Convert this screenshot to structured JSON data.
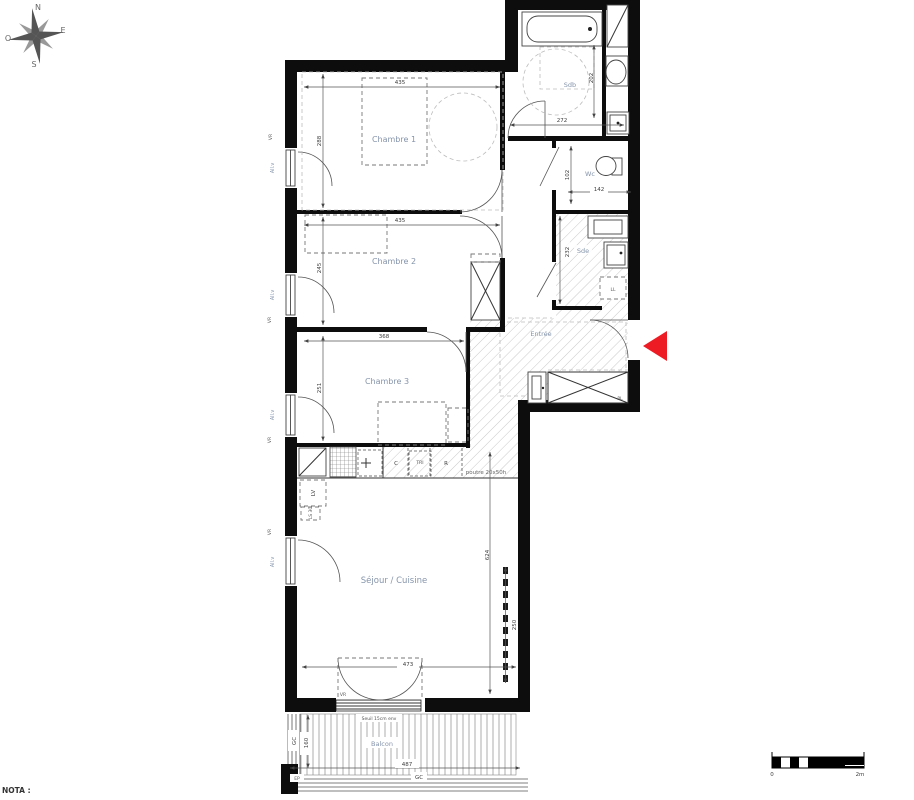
{
  "title_note": "NOTA :",
  "compass": {
    "n": "N",
    "e": "E",
    "s": "S",
    "o": "O"
  },
  "scale_bar": {
    "zero": "0",
    "two_m": "2m"
  },
  "rooms": {
    "chambre1": {
      "name": "Chambre 1",
      "w": "435",
      "h": "288"
    },
    "chambre2": {
      "name": "Chambre 2",
      "w": "435",
      "h": "245"
    },
    "chambre3": {
      "name": "Chambre 3",
      "w": "368",
      "h": "251"
    },
    "sejour": {
      "name": "Séjour / Cuisine",
      "h": "624",
      "bay": "473",
      "niche": "250"
    },
    "sdb": {
      "name": "Sdb",
      "w": "272",
      "h": "202"
    },
    "wc": {
      "name": "Wc",
      "w": "142",
      "h": "102"
    },
    "sde": {
      "name": "Sde",
      "h": "232"
    },
    "entree": {
      "name": "Entrée"
    },
    "balcon": {
      "name": "Balcon",
      "w": "487",
      "d": "160",
      "gc": "GC",
      "gc_side": "GC",
      "ep": "EP",
      "seuil": "Seuil 15cm env"
    }
  },
  "kitchen": {
    "lv": "LV",
    "ls": "LS 30",
    "c": "C",
    "tri": "TRI",
    "r": "R",
    "beam": "poutre 20x50h"
  },
  "closet": {
    "pl": "PL"
  },
  "laundry": {
    "ll": "LL"
  },
  "window_labels": {
    "allv": "All.v",
    "vr": "VR"
  },
  "colors": {
    "entrance_arrow": "#ed1c24",
    "room_label": "#8594ab",
    "wall": "#0d0d0d",
    "hatch": "#c9c9c9"
  }
}
